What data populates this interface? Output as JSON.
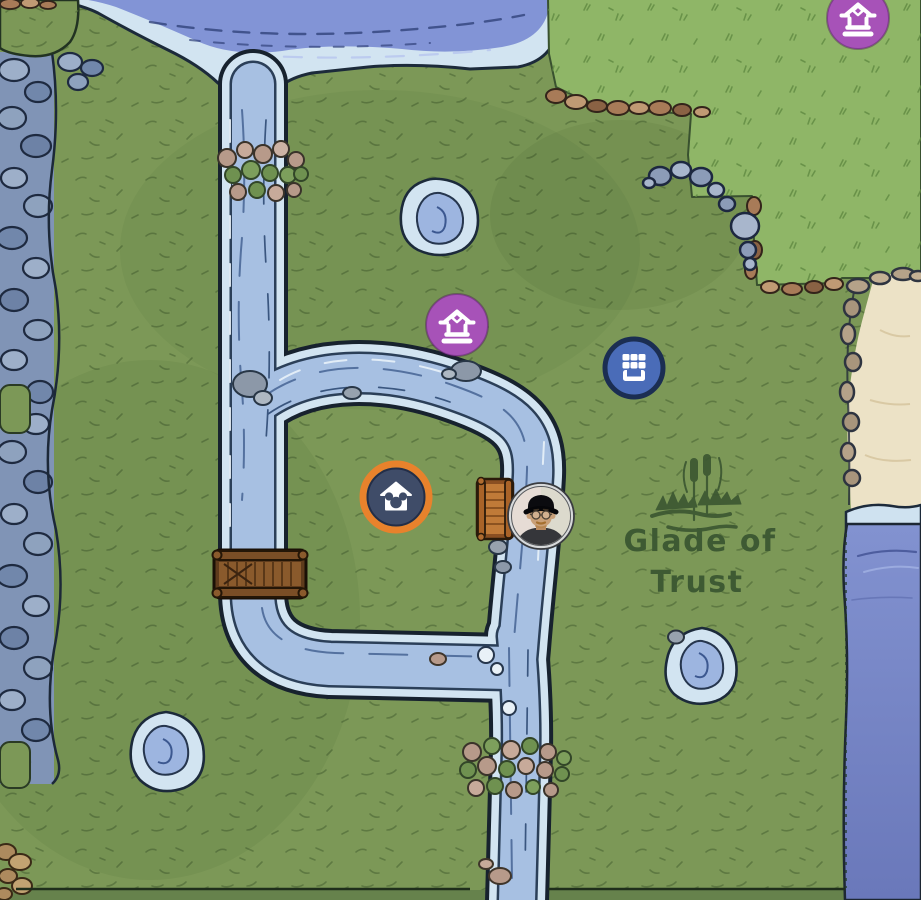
{
  "app": {
    "view": "valley-map"
  },
  "region": {
    "label_line1": "Glade of",
    "label_line2": "Trust",
    "emblem": "cattails-pond-icon",
    "label_color": "#3e5a33"
  },
  "markers": {
    "well_top": {
      "name": "well-marker-top-right",
      "glyph": "well-icon",
      "pos": "translate(858,18)",
      "color": "#a752b8"
    },
    "well_bend": {
      "name": "well-marker-river-bend",
      "glyph": "well-icon",
      "pos": "translate(457,325)",
      "color": "#a752b8"
    },
    "stall": {
      "name": "market-stall-marker",
      "glyph": "market-stall-icon",
      "pos": "translate(634,368)",
      "color": "#4a6cb8",
      "border": "#1b2e52"
    },
    "home": {
      "name": "home-marker",
      "glyph": "house-mickey-icon",
      "pos": "translate(396,497)",
      "disc": "#3f4c68",
      "ring": "#e8822c"
    },
    "player": {
      "name": "player-marker",
      "glyph": "player-avatar",
      "pos": "translate(541,516)"
    }
  },
  "terrain": {
    "field_green": "#7c9857",
    "plateau_green": "#8fb667",
    "river_light": "#d2e4f1",
    "river_mid": "#a7c0e2",
    "deep_water": "#8294d6",
    "lake_deep": "#7484c6",
    "sand": "#ece2c6",
    "cliff_rock": "#8094b6",
    "bridge_wood": "#8a5a2c",
    "outline_dark": "#17222e"
  }
}
